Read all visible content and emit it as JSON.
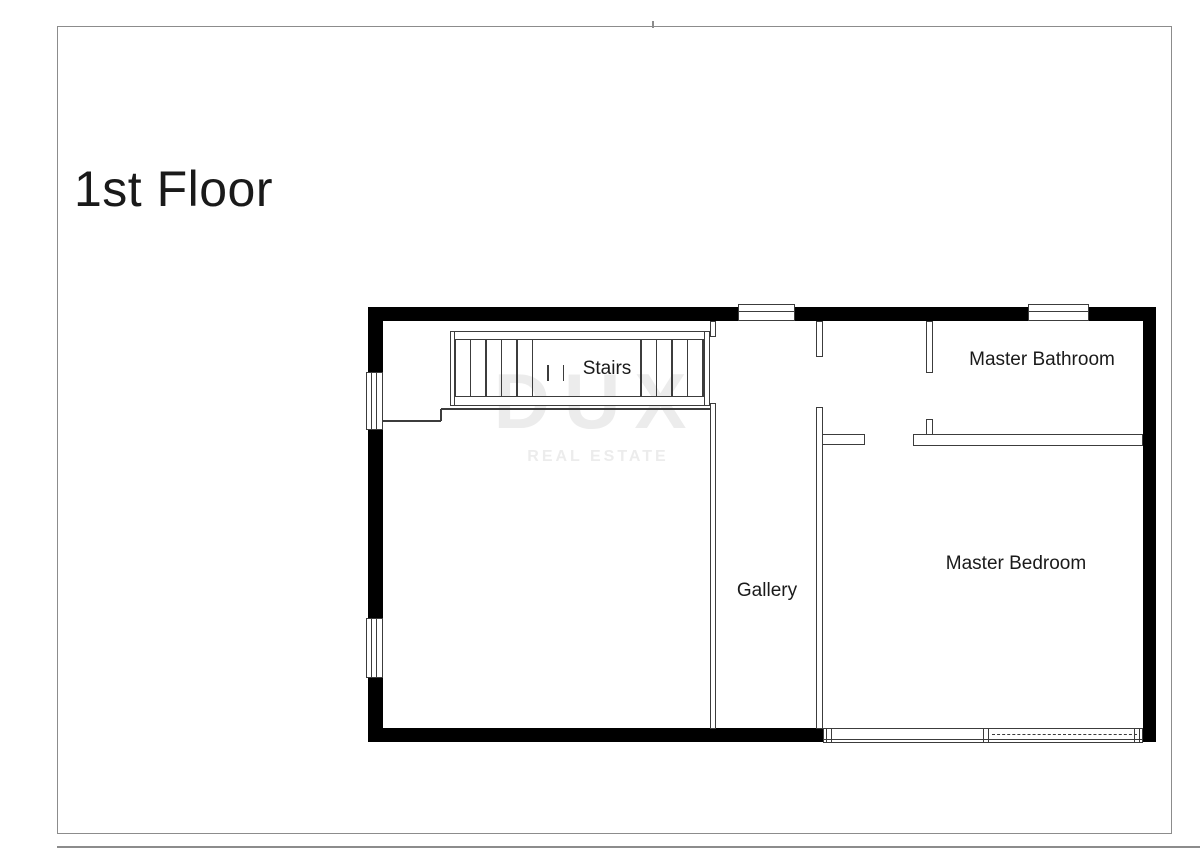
{
  "page": {
    "title": "1st Floor"
  },
  "rooms": {
    "stairs": "Stairs",
    "gallery": "Gallery",
    "master_bathroom": "Master Bathroom",
    "master_bedroom": "Master Bedroom"
  },
  "watermark": {
    "line1": "DUX",
    "line2": "REAL ESTATE"
  },
  "colors": {
    "wall": "#000000",
    "line": "#3c3c3c",
    "border": "#8c8c8c",
    "watermark": "#ececec",
    "text": "#1a1a1a"
  }
}
